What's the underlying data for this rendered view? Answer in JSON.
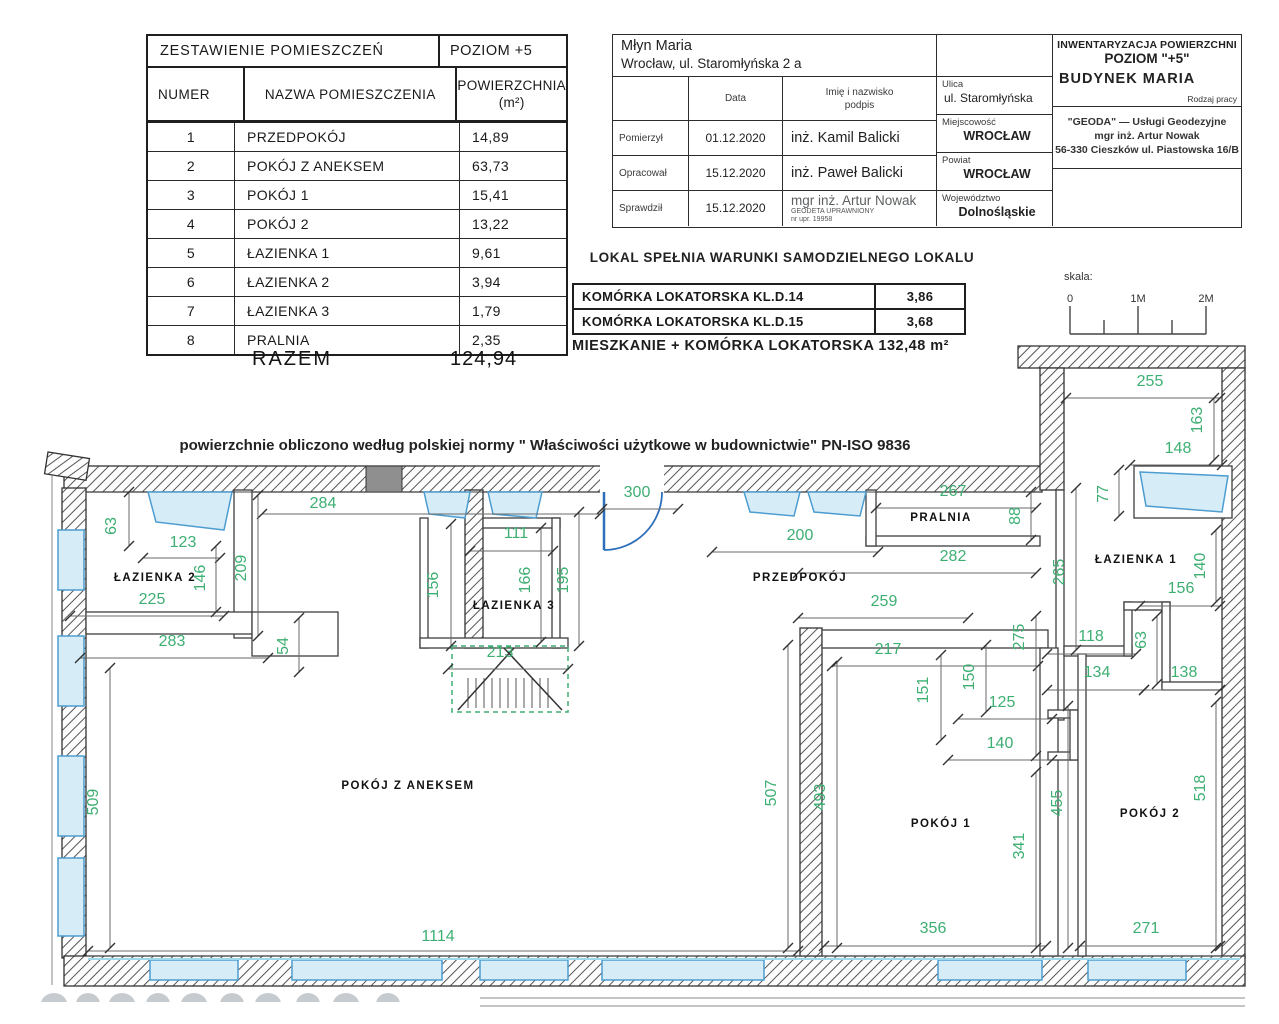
{
  "room_table": {
    "title": "ZESTAWIENIE POMIESZCZEŃ",
    "level": "POZIOM +5",
    "col_number": "NUMER",
    "col_name": "NAZWA POMIESZCZENIA",
    "col_area": "POWIERZCHNIA",
    "col_area_unit": "(m²)",
    "rows": [
      {
        "num": "1",
        "name": "PRZEDPOKÓJ",
        "area": "14,89"
      },
      {
        "num": "2",
        "name": "POKÓJ Z ANEKSEM",
        "area": "63,73"
      },
      {
        "num": "3",
        "name": "POKÓJ 1",
        "area": "15,41"
      },
      {
        "num": "4",
        "name": "POKÓJ 2",
        "area": "13,22"
      },
      {
        "num": "5",
        "name": "ŁAZIENKA 1",
        "area": "9,61"
      },
      {
        "num": "6",
        "name": "ŁAZIENKA 2",
        "area": "3,94"
      },
      {
        "num": "7",
        "name": "ŁAZIENKA 3",
        "area": "1,79"
      },
      {
        "num": "8",
        "name": "PRALNIA",
        "area": "2,35"
      }
    ],
    "total_label": "RAZEM",
    "total_value": "124,94"
  },
  "title_block": {
    "project_name": "Młyn Maria",
    "project_address": "Wrocław,  ul. Staromłyńska 2 a",
    "col_date": "Data",
    "col_person_line1": "Imię i nazwisko",
    "col_person_line2": "podpis",
    "rows": [
      {
        "role": "Pomierzył",
        "date": "01.12.2020",
        "person": "inż. Kamil Balicki"
      },
      {
        "role": "Opracował",
        "date": "15.12.2020",
        "person": "inż. Paweł Balicki"
      },
      {
        "role": "Sprawdził",
        "date": "15.12.2020",
        "person": "mgr inż. Artur Nowak",
        "note1": "GEODETA UPRAWNIONY",
        "note2": "nr upr. 19958"
      }
    ],
    "street_label": "Ulica",
    "street": "ul. Staromłyńska",
    "city_label": "Miejscowość",
    "city": "WROCŁAW",
    "county_label": "Powiat",
    "county": "WROCŁAW",
    "voivodeship_label": "Województwo",
    "voivodeship": "Dolnośląskie",
    "inventory_title": "INWENTARYZACJA POWIERZCHNI",
    "inventory_level": "POZIOM \"+5\"",
    "building": "BUDYNEK   MARIA",
    "work_type_label": "Rodzaj pracy",
    "company_line1": "\"GEODA\"  —  Usługi  Geodezyjne",
    "company_line2": "mgr inż. Artur Nowak",
    "company_line3": "56-330 Cieszków ul. Piastowska 16/B"
  },
  "summary": {
    "statement": "LOKAL  SPEŁNIA  WARUNKI  SAMODZIELNEGO  LOKALU",
    "storage_rows": [
      {
        "name": "KOMÓRKA  LOKATORSKA  KL.D.14",
        "area": "3,86"
      },
      {
        "name": "KOMÓRKA  LOKATORSKA  KL.D.15",
        "area": "3,68"
      }
    ],
    "total": "MIESZKANIE  +  KOMÓRKA  LOKATORSKA  132,48  m²"
  },
  "scale_bar": {
    "label": "skala:",
    "ticks": [
      "0",
      "1M",
      "2M"
    ]
  },
  "plan": {
    "norm_note": "powierzchnie obliczono według polskiej normy \" Właściwości użytkowe w budownictwie\"  PN-ISO 9836",
    "dimension_color": "#3daf72",
    "window_color": "#d6ecf7",
    "door_color": "#2f6fba",
    "rooms": [
      {
        "label": "ŁAZIENKA 2",
        "x": 155,
        "y": 581
      },
      {
        "label": "ŁAZIENKA 3",
        "x": 514,
        "y": 609
      },
      {
        "label": "PRZEDPOKÓJ",
        "x": 800,
        "y": 581
      },
      {
        "label": "PRALNIA",
        "x": 941,
        "y": 521
      },
      {
        "label": "ŁAZIENKA 1",
        "x": 1136,
        "y": 563
      },
      {
        "label": "POKÓJ Z ANEKSEM",
        "x": 408,
        "y": 789
      },
      {
        "label": "POKÓJ 1",
        "x": 941,
        "y": 827
      },
      {
        "label": "POKÓJ 2",
        "x": 1150,
        "y": 817
      }
    ],
    "dimensions": [
      {
        "v": "284",
        "x": 323,
        "y": 508,
        "l": [
          262,
          514,
          600,
          514
        ]
      },
      {
        "v": "123",
        "x": 183,
        "y": 547,
        "l": [
          143,
          558,
          220,
          558
        ]
      },
      {
        "v": "225",
        "x": 152,
        "y": 604,
        "l": [
          70,
          616,
          224,
          616
        ]
      },
      {
        "v": "283",
        "x": 172,
        "y": 646,
        "l": [
          80,
          658,
          268,
          658
        ]
      },
      {
        "v": "111",
        "x": 516,
        "y": 538,
        "l": [
          470,
          551,
          553,
          551
        ]
      },
      {
        "v": "213",
        "x": 500,
        "y": 657,
        "l": [
          448,
          669,
          568,
          669
        ]
      },
      {
        "v": "300",
        "x": 637,
        "y": 497,
        "l": [
          602,
          509,
          678,
          509
        ]
      },
      {
        "v": "267",
        "x": 953,
        "y": 496,
        "l": [
          876,
          508,
          1036,
          508
        ]
      },
      {
        "v": "200",
        "x": 800,
        "y": 540,
        "l": [
          712,
          552,
          878,
          552
        ]
      },
      {
        "v": "282",
        "x": 953,
        "y": 561,
        "l": [
          798,
          573,
          1036,
          573
        ]
      },
      {
        "v": "259",
        "x": 884,
        "y": 606,
        "l": [
          798,
          618,
          968,
          618
        ]
      },
      {
        "v": "217",
        "x": 888,
        "y": 654,
        "l": [
          832,
          666,
          1038,
          666
        ]
      },
      {
        "v": "125",
        "x": 1002,
        "y": 707,
        "l": [
          958,
          719,
          1052,
          719
        ]
      },
      {
        "v": "140",
        "x": 1000,
        "y": 748,
        "l": [
          948,
          760,
          1052,
          760
        ]
      },
      {
        "v": "118",
        "x": 1091,
        "y": 641,
        "l": [
          1047,
          654,
          1136,
          654
        ]
      },
      {
        "v": "134",
        "x": 1097,
        "y": 677,
        "l": [
          1047,
          690,
          1144,
          690
        ]
      },
      {
        "v": "138",
        "x": 1184,
        "y": 677,
        "l": [
          1144,
          690,
          1220,
          690
        ]
      },
      {
        "v": "156",
        "x": 1181,
        "y": 593,
        "l": [
          1140,
          606,
          1220,
          606
        ]
      },
      {
        "v": "148",
        "x": 1178,
        "y": 453,
        "l": [
          1130,
          465,
          1222,
          465
        ]
      },
      {
        "v": "255",
        "x": 1150,
        "y": 386,
        "l": [
          1066,
          398,
          1220,
          398
        ]
      },
      {
        "v": "1114",
        "x": 438,
        "y": 941,
        "l": [
          88,
          951,
          798,
          951
        ]
      },
      {
        "v": "356",
        "x": 933,
        "y": 933,
        "l": [
          824,
          946,
          1046,
          946
        ]
      },
      {
        "v": "271",
        "x": 1146,
        "y": 933,
        "l": [
          1080,
          946,
          1220,
          946
        ]
      },
      {
        "v": "63",
        "x": 116,
        "y": 526,
        "r": -90,
        "l": [
          129,
          492,
          129,
          546
        ]
      },
      {
        "v": "146",
        "x": 205,
        "y": 578,
        "r": -90,
        "l": [
          216,
          546,
          216,
          612
        ]
      },
      {
        "v": "209",
        "x": 246,
        "y": 568,
        "r": -90,
        "l": [
          258,
          495,
          258,
          636
        ]
      },
      {
        "v": "54",
        "x": 288,
        "y": 646,
        "r": -90,
        "l": [
          299,
          618,
          299,
          672
        ]
      },
      {
        "v": "156",
        "x": 438,
        "y": 585,
        "r": -90,
        "l": [
          451,
          524,
          451,
          646
        ]
      },
      {
        "v": "166",
        "x": 530,
        "y": 580,
        "r": -90,
        "l": [
          541,
          528,
          541,
          642
        ]
      },
      {
        "v": "195",
        "x": 568,
        "y": 580,
        "r": -90,
        "l": [
          579,
          512,
          579,
          646
        ]
      },
      {
        "v": "88",
        "x": 1020,
        "y": 516,
        "r": -90,
        "l": [
          1031,
          492,
          1031,
          540
        ]
      },
      {
        "v": "265",
        "x": 1064,
        "y": 572,
        "r": -90,
        "l": [
          1076,
          488,
          1076,
          650
        ]
      },
      {
        "v": "275",
        "x": 1024,
        "y": 637,
        "r": -90,
        "l": [
          1036,
          616,
          1036,
          756
        ]
      },
      {
        "v": "151",
        "x": 928,
        "y": 690,
        "r": -90,
        "l": [
          941,
          655,
          941,
          740
        ]
      },
      {
        "v": "150",
        "x": 974,
        "y": 677,
        "r": -90,
        "l": [
          986,
          645,
          986,
          712
        ]
      },
      {
        "v": "63",
        "x": 1146,
        "y": 640,
        "r": -90,
        "l": [
          1157,
          616,
          1157,
          684
        ]
      },
      {
        "v": "163",
        "x": 1202,
        "y": 420,
        "r": -90,
        "l": [
          1214,
          398,
          1214,
          460
        ]
      },
      {
        "v": "77",
        "x": 1108,
        "y": 494,
        "r": -90,
        "l": [
          1119,
          470,
          1119,
          516
        ]
      },
      {
        "v": "140",
        "x": 1205,
        "y": 566,
        "r": -90,
        "l": [
          1216,
          530,
          1216,
          602
        ]
      },
      {
        "v": "509",
        "x": 98,
        "y": 802,
        "r": -90,
        "l": [
          110,
          668,
          110,
          948
        ]
      },
      {
        "v": "507",
        "x": 776,
        "y": 793,
        "r": -90,
        "l": [
          788,
          645,
          788,
          948
        ]
      },
      {
        "v": "493",
        "x": 825,
        "y": 797,
        "r": -90,
        "l": [
          837,
          662,
          837,
          948
        ]
      },
      {
        "v": "341",
        "x": 1024,
        "y": 846,
        "r": -90,
        "l": [
          1036,
          772,
          1036,
          948
        ]
      },
      {
        "v": "455",
        "x": 1062,
        "y": 803,
        "r": -90,
        "l": [
          1068,
          706,
          1068,
          948
        ]
      },
      {
        "v": "518",
        "x": 1205,
        "y": 788,
        "r": -90,
        "l": [
          1216,
          702,
          1216,
          948
        ]
      }
    ]
  }
}
